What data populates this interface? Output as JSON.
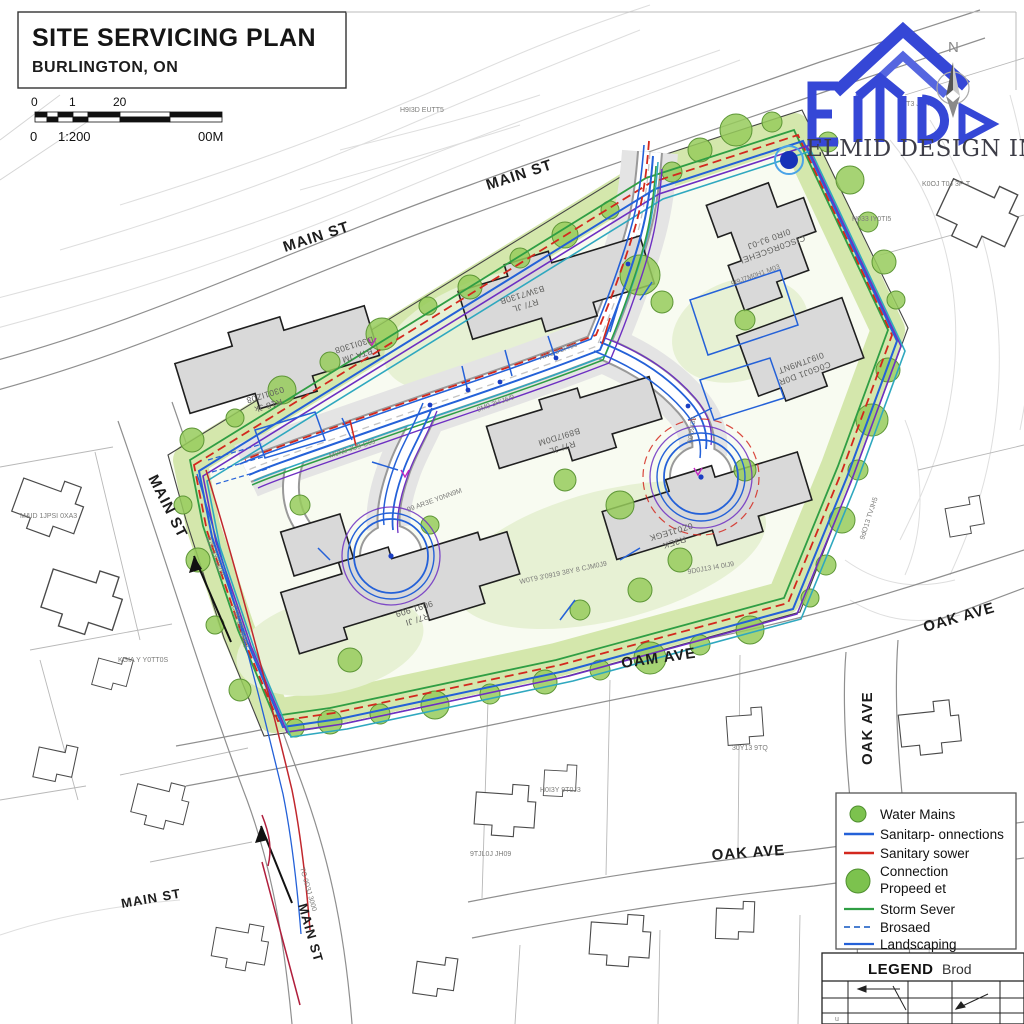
{
  "title_block": {
    "title": "SITE SERVICING PLAN",
    "subtitle": "BURLINGTON, ON"
  },
  "scale_bar": {
    "tick0": "0",
    "tick1": "1",
    "tick2": "20",
    "bottom_left": "0",
    "ratio": "1:200",
    "bottom_right": "00M"
  },
  "logo": {
    "company": "ELMID DESIGN INC.",
    "north_label": "N"
  },
  "streets": {
    "main_st_top_left": "MAIN ST",
    "main_st_top_right": "MAIN ST",
    "main_st_left": "MAIN ST",
    "main_st_bottom": "MAIN ST",
    "main_st_bottom_vertical": "MAIN ST",
    "oak_ave_right": "OAK AVE",
    "oak_ave_right_vertical": "OAK AVE",
    "oam_ave": "OAM AVE",
    "oak_ave_bottom": "OAK AVE"
  },
  "buildings": [
    {
      "line1": "R18 Jk",
      "line2": "0301IZ08"
    },
    {
      "line1": "BTA JM",
      "line2": "D30I1308"
    },
    {
      "line1": "R7/ JL",
      "line2": "B3W7130B"
    },
    {
      "line1": "CISC0RGCEHEI",
      "line2": "0IR0 9J-0J"
    },
    {
      "line1": "C0G0J1 D0R",
      "line2": "0I9JTM9NT"
    },
    {
      "line1": "R7/ JL",
      "line2": "B89I7D0M"
    },
    {
      "line1": "R7/ JI",
      "line2": "9091 909"
    },
    {
      "line1": "R3EK",
      "line2": "0Z0J1EGK"
    }
  ],
  "legend": {
    "items": [
      {
        "label": "Water Mains",
        "symbol": "circle-green"
      },
      {
        "label": "Sanitarp- onnections",
        "symbol": "line-blue"
      },
      {
        "label": "Sanitary sower",
        "symbol": "line-red"
      },
      {
        "label": "Connection",
        "label2": "Propeed  et",
        "symbol": "circle-green-large"
      },
      {
        "label": "Storm Sever",
        "symbol": "line-green"
      },
      {
        "label": "Brosaed",
        "symbol": "line-blue-dashed"
      },
      {
        "label": "Landscaping",
        "symbol": "line-blue"
      }
    ]
  },
  "legend_table": {
    "title": "LEGEND",
    "title_suffix": "Brod",
    "cell_note": "u"
  },
  "annotations": [
    {
      "text": "H9I3D EUTT5"
    },
    {
      "text": "K0OJ T0J 3P-T"
    },
    {
      "text": "H033 IY0TI5"
    },
    {
      "text": "M&ID 1JPSI 0XA3"
    },
    {
      "text": "KGIA Y Y0TT0S"
    },
    {
      "text": "TO 0D3J 3000"
    },
    {
      "text": "C'09 9S AR03"
    },
    {
      "text": "8Z0 9Y-0&0Y"
    },
    {
      "text": "AW3 3'0P/90"
    },
    {
      "text": "9M9 3H'J6/9"
    },
    {
      "text": "M0N9 JU9-C09"
    },
    {
      "text": "99 AR3E Y0NN9M"
    },
    {
      "text": "W0T9 3'0919 38Y 8 CJM0J9"
    },
    {
      "text": "9I9J7M0H1 M03"
    },
    {
      "text": "9D0J13 I4 0IJ9"
    },
    {
      "text": "9dO13 TVJH5"
    },
    {
      "text": "B0D9I39"
    },
    {
      "text": "30Y13 9TQ"
    },
    {
      "text": "H0I3Y 9T0J3"
    },
    {
      "text": "9TJL0J JH09"
    },
    {
      "text": "F0T3 JfTTH"
    }
  ],
  "colors": {
    "water_blue": "#2461d8",
    "sanitary_red": "#d3281e",
    "storm_green": "#2f9e44",
    "purple": "#6d2fc2",
    "teal": "#2fa8bf",
    "landscape": "#d4e7ac",
    "tree": "#97cb5c",
    "building_gray": "#d9d9d9",
    "logo_blue": "#3547d6"
  }
}
